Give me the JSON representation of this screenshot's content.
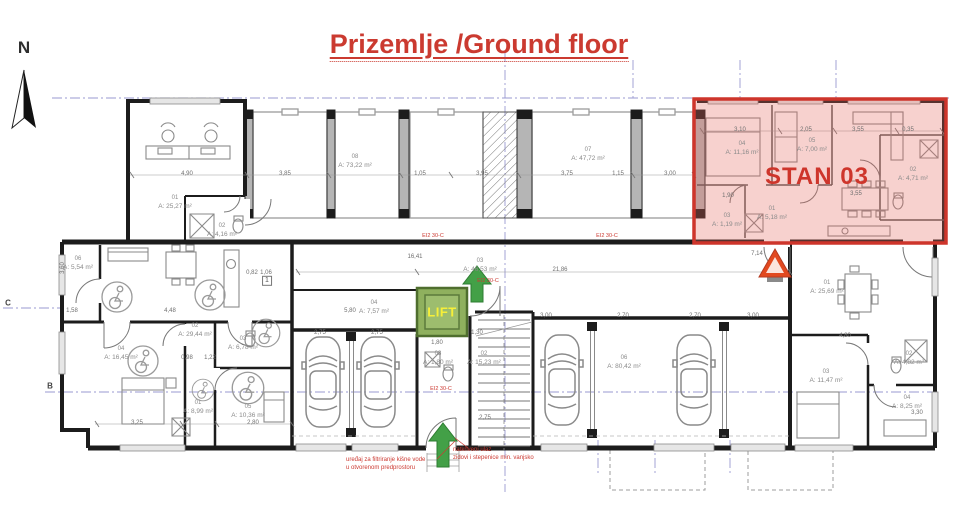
{
  "title": "Prizemlje /Ground floor",
  "north_label": "N",
  "stan03_label": "STAN 03",
  "lift_label": "LIFT",
  "accent_colors": {
    "red": "#ce352b",
    "green_arrow": "#43a047",
    "lift_green": "#8fb05e",
    "lift_text_yellow": "#f6ef39"
  },
  "axis_labels": [
    {
      "t": "C",
      "x": 8,
      "y": 303
    },
    {
      "t": "B",
      "x": 50,
      "y": 386
    }
  ],
  "rooms": [
    {
      "id": "01",
      "area": "A: 25,27 m²",
      "x": 175,
      "y": 203
    },
    {
      "id": "02",
      "area": "A: 4,16 m²",
      "x": 222,
      "y": 231
    },
    {
      "id": "08",
      "area": "A: 73,22 m²",
      "x": 355,
      "y": 162
    },
    {
      "id": "07",
      "area": "A: 47,72 m²",
      "x": 588,
      "y": 155
    },
    {
      "id": "04",
      "area": "A: 11,16 m²",
      "x": 742,
      "y": 149
    },
    {
      "id": "05",
      "area": "A: 7,00 m²",
      "x": 812,
      "y": 146
    },
    {
      "id": "02",
      "area": "A: 4,71 m²",
      "x": 913,
      "y": 175
    },
    {
      "id": "01",
      "area": "A: 5,18 m²",
      "x": 772,
      "y": 214
    },
    {
      "id": "03",
      "area": "A: 1,19 m²",
      "x": 727,
      "y": 221
    },
    {
      "id": "03",
      "area": "A: 46,53 m²",
      "x": 480,
      "y": 266
    },
    {
      "id": "06",
      "area": "A: 5,54 m²",
      "x": 78,
      "y": 264
    },
    {
      "id": "02",
      "area": "A: 29,44 m²",
      "x": 195,
      "y": 331
    },
    {
      "id": "04",
      "area": "A: 16,45 m²",
      "x": 121,
      "y": 354
    },
    {
      "id": "03",
      "area": "A: 6,78 m²",
      "x": 243,
      "y": 344
    },
    {
      "id": "01",
      "area": "A: 8,99 m²",
      "x": 198,
      "y": 408
    },
    {
      "id": "05",
      "area": "A: 10,36 m²",
      "x": 248,
      "y": 412
    },
    {
      "id": "04",
      "area": "A: 7,57 m²",
      "x": 374,
      "y": 308
    },
    {
      "id": "02",
      "area": "A: 15,23 m²",
      "x": 484,
      "y": 359
    },
    {
      "id": "03",
      "area": "A: 1,80 m²",
      "x": 438,
      "y": 359
    },
    {
      "id": "06",
      "area": "A: 80,42 m²",
      "x": 624,
      "y": 363
    },
    {
      "id": "01",
      "area": "A: 25,69 m²",
      "x": 827,
      "y": 288
    },
    {
      "id": "03",
      "area": "A: 11,47 m²",
      "x": 826,
      "y": 377
    },
    {
      "id": "02",
      "area": "A: 4,82 m²",
      "x": 909,
      "y": 359
    },
    {
      "id": "04",
      "area": "A: 8,25 m²",
      "x": 907,
      "y": 403
    }
  ],
  "dimensions": [
    {
      "t": "4,90",
      "x": 187,
      "y": 174
    },
    {
      "t": "3,85",
      "x": 285,
      "y": 174
    },
    {
      "t": "1,05",
      "x": 420,
      "y": 174
    },
    {
      "t": "3,95",
      "x": 482,
      "y": 174
    },
    {
      "t": "3,75",
      "x": 567,
      "y": 174
    },
    {
      "t": "1,15",
      "x": 618,
      "y": 174
    },
    {
      "t": "3,00",
      "x": 670,
      "y": 174
    },
    {
      "t": "3,10",
      "x": 740,
      "y": 130
    },
    {
      "t": "2,05",
      "x": 806,
      "y": 130
    },
    {
      "t": "3,55",
      "x": 858,
      "y": 130
    },
    {
      "t": "0,35",
      "x": 908,
      "y": 130
    },
    {
      "t": "16,41",
      "x": 415,
      "y": 257
    },
    {
      "t": "21,86",
      "x": 560,
      "y": 270
    },
    {
      "t": "7,14",
      "x": 757,
      "y": 254
    },
    {
      "t": "1,90",
      "x": 728,
      "y": 196
    },
    {
      "t": "3,55",
      "x": 856,
      "y": 194
    },
    {
      "t": "5,80",
      "x": 350,
      "y": 311
    },
    {
      "t": "2,75",
      "x": 320,
      "y": 333
    },
    {
      "t": "2,75",
      "x": 377,
      "y": 333
    },
    {
      "t": "1,80",
      "x": 437,
      "y": 343
    },
    {
      "t": "1,30",
      "x": 477,
      "y": 333
    },
    {
      "t": "3,00",
      "x": 546,
      "y": 316
    },
    {
      "t": "2,70",
      "x": 623,
      "y": 316
    },
    {
      "t": "2,70",
      "x": 695,
      "y": 316
    },
    {
      "t": "3,00",
      "x": 753,
      "y": 316
    },
    {
      "t": "0,82",
      "x": 252,
      "y": 273
    },
    {
      "t": "1,06",
      "x": 266,
      "y": 273
    },
    {
      "t": "1,58",
      "x": 72,
      "y": 311
    },
    {
      "t": "4,48",
      "x": 170,
      "y": 311
    },
    {
      "t": "0,98",
      "x": 187,
      "y": 358
    },
    {
      "t": "1,22",
      "x": 210,
      "y": 358
    },
    {
      "t": "3,25",
      "x": 137,
      "y": 423
    },
    {
      "t": "2,80",
      "x": 253,
      "y": 423
    },
    {
      "t": "2,75",
      "x": 485,
      "y": 418
    },
    {
      "t": "4,80",
      "x": 845,
      "y": 336
    },
    {
      "t": "3,30",
      "x": 917,
      "y": 413
    },
    {
      "t": "3,60",
      "x": 63,
      "y": 268,
      "v": 1
    }
  ],
  "fire_labels": [
    {
      "t": "EI2 30-C",
      "x": 433,
      "y": 236
    },
    {
      "t": "EI2 30-C",
      "x": 607,
      "y": 236
    },
    {
      "t": "EI2 30-C",
      "x": 488,
      "y": 281
    },
    {
      "t": "EI2 30-C",
      "x": 441,
      "y": 389
    }
  ],
  "annotations": [
    {
      "lines": [
        "uređaj za filtriranje kišne vode",
        "u otvorenom predprostoru"
      ],
      "x": 346,
      "y": 456
    },
    {
      "lines": [
        "natkriveni ulaz",
        "zidovi i stepenice min. vanjsko"
      ],
      "x": 453,
      "y": 446
    }
  ],
  "parking_tags": [
    {
      "t": "1",
      "x": 267,
      "y": 281
    }
  ]
}
